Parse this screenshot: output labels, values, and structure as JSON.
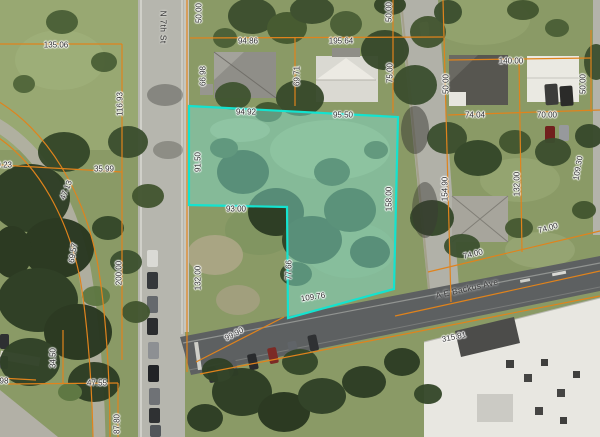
{
  "map": {
    "description": "Aerial parcel map with a selected parcel highlighted in teal",
    "colors": {
      "parcel_boundary": "#e0831c",
      "selected_parcel_outline": "#14e3cf",
      "selected_parcel_fill": "rgba(127,217,201,0.5)",
      "dimension_label_text": "#2e2e2e"
    },
    "streets": [
      {
        "name": "N 7th St",
        "x": 163,
        "y": 27,
        "r": 90
      },
      {
        "name": "A E Backus Ave",
        "x": 467,
        "y": 289,
        "r": -13
      }
    ],
    "dimension_labels": [
      {
        "text": "135.06",
        "x": 56,
        "y": 45,
        "r": 0
      },
      {
        "text": "116.93",
        "x": 120,
        "y": 104,
        "r": -90
      },
      {
        "text": "50.00",
        "x": 199,
        "y": 13,
        "r": -90
      },
      {
        "text": "94.86",
        "x": 248,
        "y": 41,
        "r": 0
      },
      {
        "text": "195.64",
        "x": 341,
        "y": 41,
        "r": 0
      },
      {
        "text": "50.00",
        "x": 389,
        "y": 12,
        "r": -90
      },
      {
        "text": "66.98",
        "x": 203,
        "y": 76,
        "r": -90
      },
      {
        "text": "69.71",
        "x": 297,
        "y": 76,
        "r": -90
      },
      {
        "text": "75.00",
        "x": 390,
        "y": 73,
        "r": -90
      },
      {
        "text": "140.00",
        "x": 511,
        "y": 61,
        "r": 0
      },
      {
        "text": "50.00",
        "x": 446,
        "y": 84,
        "r": -90
      },
      {
        "text": "50.00",
        "x": 583,
        "y": 84,
        "r": -90
      },
      {
        "text": "74.04",
        "x": 475,
        "y": 115,
        "r": 0
      },
      {
        "text": "70.00",
        "x": 547,
        "y": 115,
        "r": 0
      },
      {
        "text": "94.92",
        "x": 246,
        "y": 112,
        "r": 0
      },
      {
        "text": "95.50",
        "x": 343,
        "y": 115,
        "r": 0
      },
      {
        "text": "91.50",
        "x": 198,
        "y": 162,
        "r": -90
      },
      {
        "text": "93.00",
        "x": 236,
        "y": 209,
        "r": 0
      },
      {
        "text": "154.90",
        "x": 445,
        "y": 189,
        "r": -90
      },
      {
        "text": "158.00",
        "x": 389,
        "y": 199,
        "r": -90
      },
      {
        "text": "132.00",
        "x": 517,
        "y": 184,
        "r": -90
      },
      {
        "text": "109.30",
        "x": 578,
        "y": 168,
        "r": -80
      },
      {
        "text": "74.00",
        "x": 548,
        "y": 228,
        "r": -16
      },
      {
        "text": "74.00",
        "x": 473,
        "y": 254,
        "r": -14
      },
      {
        "text": "315.81",
        "x": 454,
        "y": 337,
        "r": -12
      },
      {
        "text": "109.76",
        "x": 313,
        "y": 297,
        "r": -9
      },
      {
        "text": "77.66",
        "x": 289,
        "y": 270,
        "r": -90
      },
      {
        "text": "99.90",
        "x": 234,
        "y": 334,
        "r": -28
      },
      {
        "text": "132.00",
        "x": 198,
        "y": 278,
        "r": -90
      },
      {
        "text": "200.00",
        "x": 119,
        "y": 273,
        "r": -90
      },
      {
        "text": "35.99",
        "x": 104,
        "y": 169,
        "r": 0
      },
      {
        "text": "47.13",
        "x": 66,
        "y": 190,
        "r": -68
      },
      {
        "text": "69.57",
        "x": 73,
        "y": 253,
        "r": -80
      },
      {
        "text": "69.23",
        "x": 2,
        "y": 165,
        "r": 0
      },
      {
        "text": "34.50",
        "x": 53,
        "y": 358,
        "r": -90
      },
      {
        "text": "47.55",
        "x": 97,
        "y": 383,
        "r": 0
      },
      {
        "text": "87.80",
        "x": 117,
        "y": 424,
        "r": -90
      },
      {
        "text": "98",
        "x": 4,
        "y": 381,
        "r": 0
      }
    ]
  }
}
